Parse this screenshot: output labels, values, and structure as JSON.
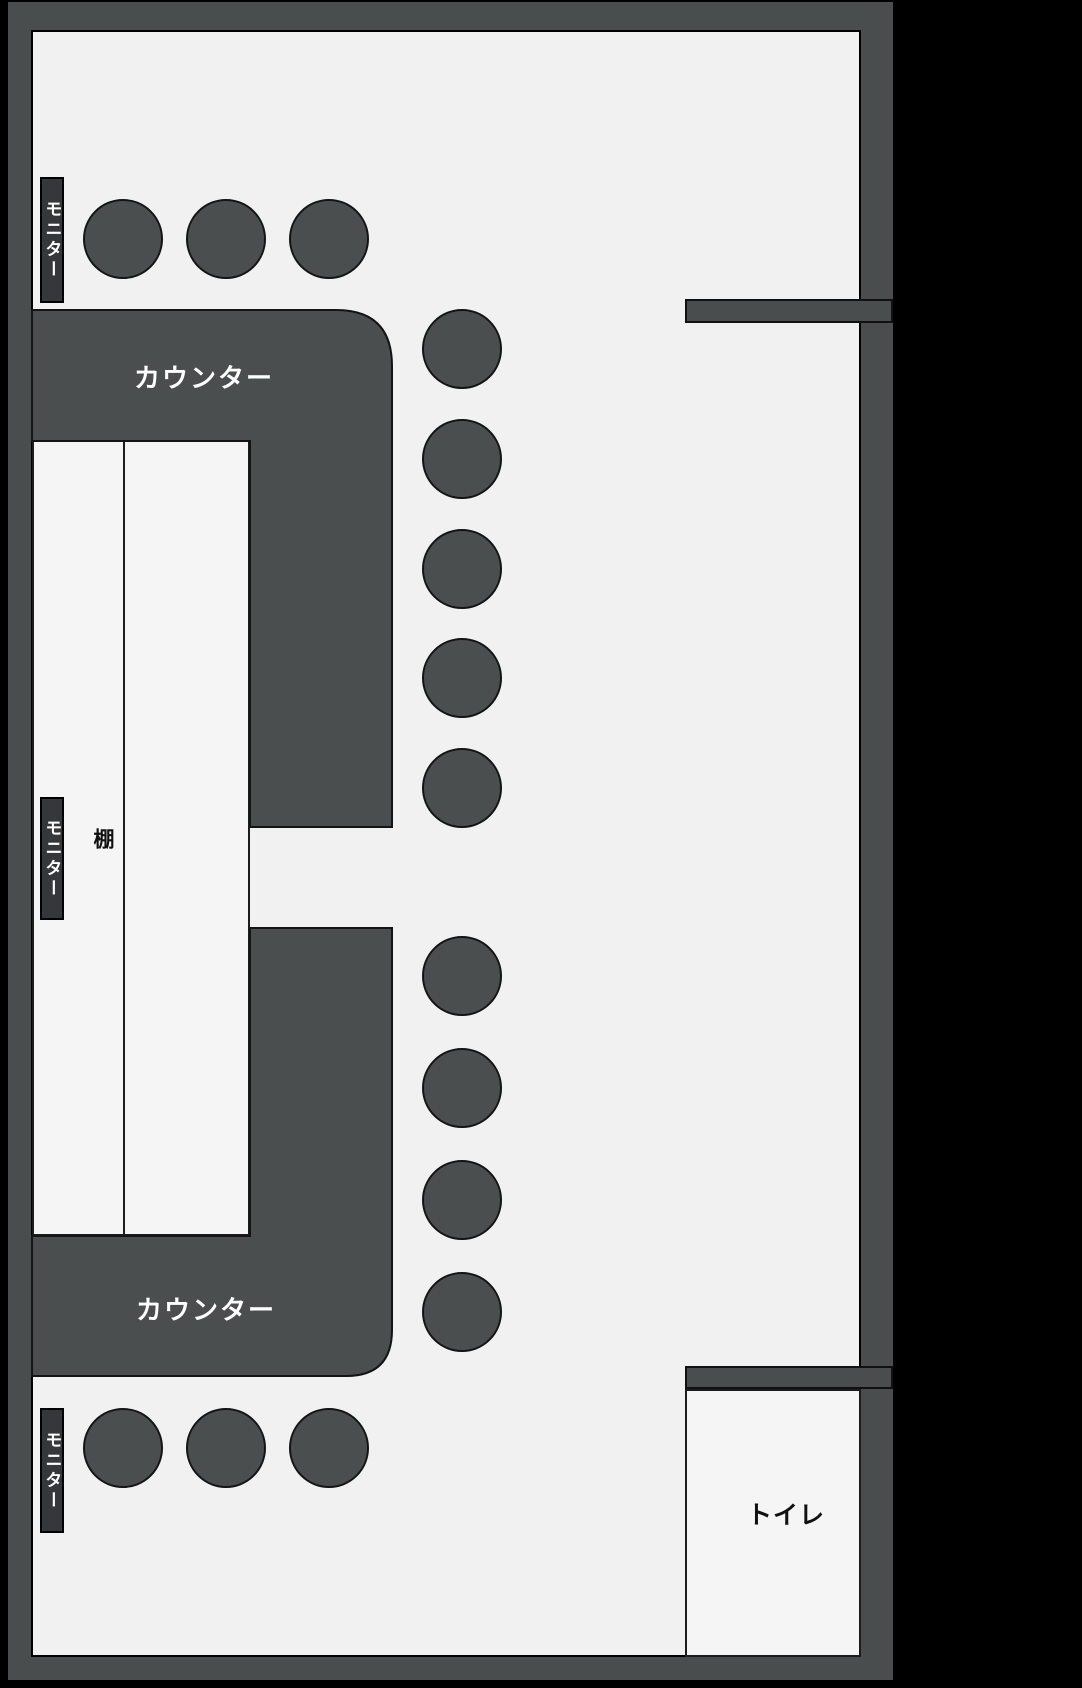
{
  "canvas": {
    "width": 1082,
    "height": 1688
  },
  "colors": {
    "background": "#000000",
    "wall": "#4a4d4d",
    "floor": "#f1f1f1",
    "furniture": "#4b4e4e",
    "room": "#f5f5f5",
    "monitor_strip": "#35383a",
    "label_light": "#ffffff",
    "label_dark": "#111111"
  },
  "labels": {
    "counter_top": "カウンター",
    "counter_bottom": "カウンター",
    "shelf": "棚",
    "toilet": "トイレ",
    "monitor": "モニター"
  },
  "monitors": [
    {
      "x": 40,
      "y": 177,
      "w": 24,
      "h": 126
    },
    {
      "x": 40,
      "y": 797,
      "w": 24,
      "h": 123
    },
    {
      "x": 40,
      "y": 1408,
      "w": 24,
      "h": 125
    }
  ],
  "partitions": [
    {
      "x": 685,
      "y": 299,
      "w": 208,
      "h": 24
    },
    {
      "x": 685,
      "y": 1366,
      "w": 208,
      "h": 23
    }
  ],
  "seats": {
    "radius": 40,
    "positions": [
      [
        123,
        239
      ],
      [
        226,
        239
      ],
      [
        329,
        239
      ],
      [
        462,
        349
      ],
      [
        462,
        459
      ],
      [
        462,
        569
      ],
      [
        462,
        678
      ],
      [
        462,
        788
      ],
      [
        462,
        976
      ],
      [
        462,
        1088
      ],
      [
        462,
        1200
      ],
      [
        462,
        1312
      ],
      [
        123,
        1448
      ],
      [
        226,
        1448
      ],
      [
        329,
        1448
      ]
    ]
  }
}
